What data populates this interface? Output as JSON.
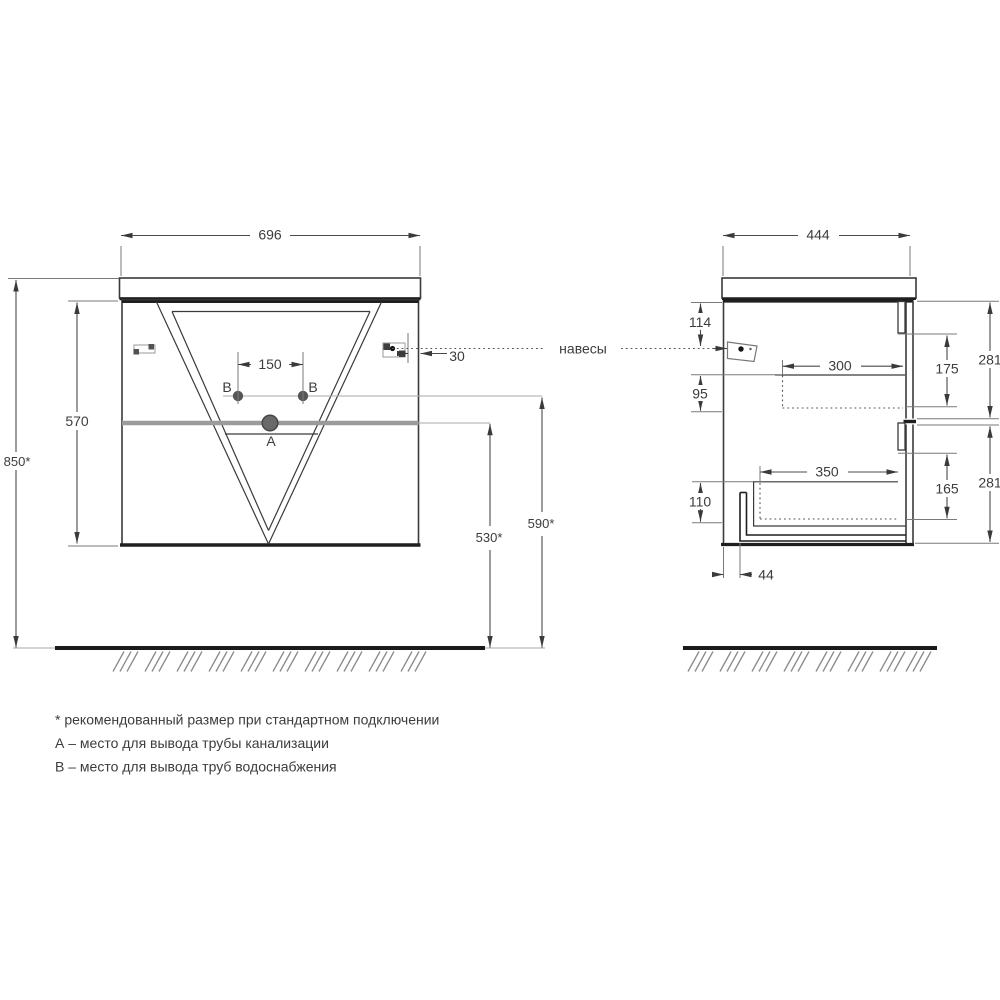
{
  "front_view": {
    "width": "696",
    "cabinet_height": "570",
    "mount_height": "850*",
    "outlet_spacing": "150",
    "hanger_offset": "30",
    "drain_outlet_height": "530*",
    "supply_outlet_height": "590*",
    "label_a": "А",
    "label_b_left": "В",
    "label_b_right": "В"
  },
  "side_view": {
    "depth": "444",
    "hanger_drop": "114",
    "gap_top": "95",
    "gap_bottom": "110",
    "bottom_clearance": "44",
    "top_drawer_depth": "300",
    "bottom_drawer_depth": "350",
    "top_drawer_height": "175",
    "bottom_drawer_height": "165",
    "front_top_height": "281",
    "front_bottom_height": "281"
  },
  "annotations": {
    "hangers_label": "навесы",
    "note_asterisk": "* рекомендованный размер при стандартном подключении",
    "note_a": "А – место для вывода трубы канализации",
    "note_b": "В – место для вывода труб водоснабжения"
  },
  "colors": {
    "object_line": "#3a3a3a",
    "dark_edge": "#1f1f1f",
    "divider_gray": "#9b9b9b",
    "ground": "#1a1a1a",
    "background": "#ffffff"
  }
}
